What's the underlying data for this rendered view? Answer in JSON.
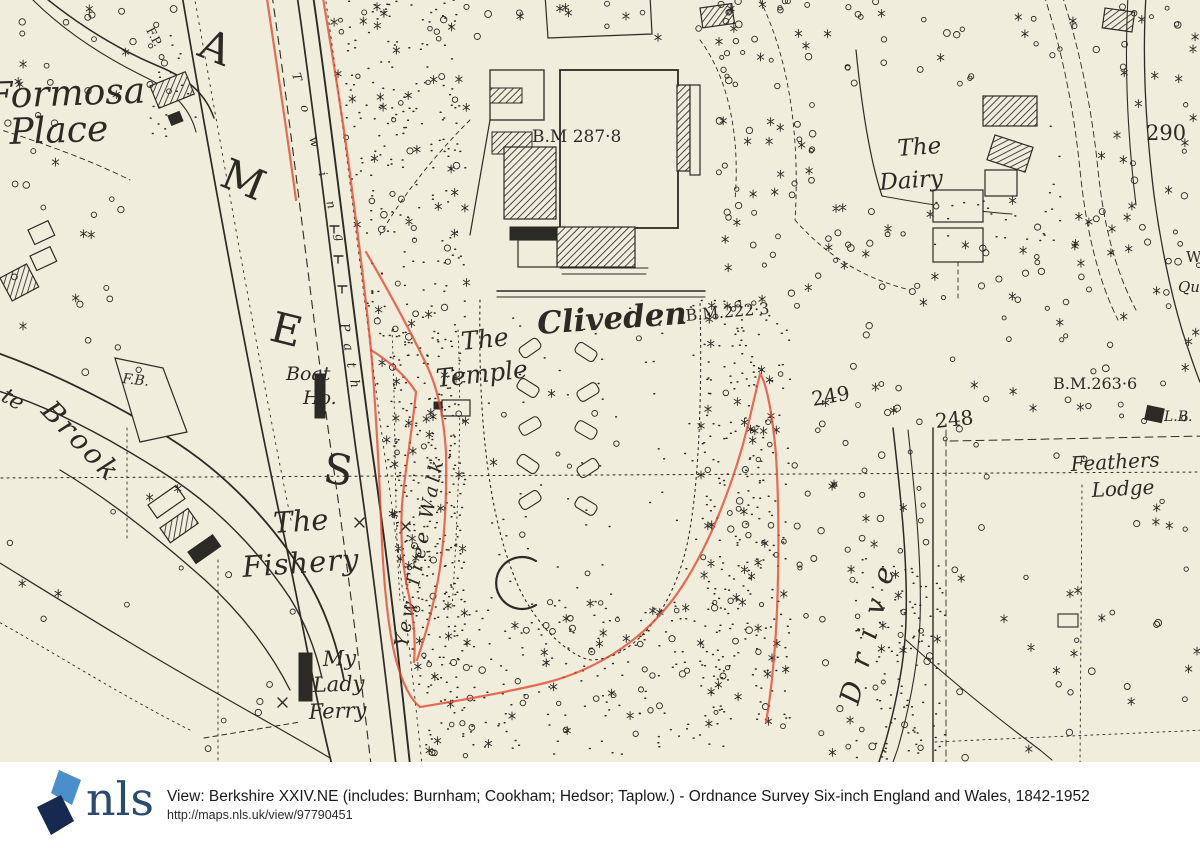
{
  "footer": {
    "logo_text": "nls",
    "title_line": "View: Berkshire XXIV.NE (includes: Burnham; Cookham; Hedsor; Taplow.) - Ordnance Survey Six-inch England and Wales, 1842-1952",
    "url_line": "http://maps.nls.uk/view/97790451",
    "colors": {
      "logo_navy": "#16294f",
      "logo_blue": "#4a8fc9",
      "logo_wordmark": "#2b4a70",
      "text": "#1a1a1a"
    }
  },
  "map": {
    "colors": {
      "paper": "#f1eddc",
      "ink": "#2b2a24",
      "red_overlay": "#e2452e"
    },
    "labels": [
      {
        "id": "formosa",
        "text": "Formosa",
        "x": -12,
        "y": 108,
        "size": 36,
        "rot": -2,
        "italic": true
      },
      {
        "id": "place",
        "text": "Place",
        "x": 10,
        "y": 144,
        "size": 36,
        "rot": -2,
        "italic": true
      },
      {
        "id": "thames-a",
        "text": "A",
        "x": 196,
        "y": 55,
        "size": 42,
        "rot": 22
      },
      {
        "id": "thames-m",
        "text": "M",
        "x": 218,
        "y": 185,
        "size": 42,
        "rot": 22
      },
      {
        "id": "thames-e",
        "text": "E",
        "x": 268,
        "y": 340,
        "size": 42,
        "rot": 14
      },
      {
        "id": "thames-s",
        "text": "S",
        "x": 322,
        "y": 482,
        "size": 42,
        "rot": 8
      },
      {
        "id": "towing",
        "text": "Towing",
        "x": 292,
        "y": 74,
        "size": 12,
        "rot": 75,
        "ls": 26,
        "italic": true
      },
      {
        "id": "path",
        "text": "Path",
        "x": 340,
        "y": 324,
        "size": 13,
        "rot": 80,
        "ls": 12,
        "italic": true
      },
      {
        "id": "fp",
        "text": "F.P.",
        "x": 146,
        "y": 30,
        "size": 12,
        "rot": 62
      },
      {
        "id": "fb",
        "text": "F.B.",
        "x": 122,
        "y": 383,
        "size": 14,
        "rot": 6,
        "italic": true
      },
      {
        "id": "tebrook-te",
        "text": "te",
        "x": 0,
        "y": 400,
        "size": 22,
        "rot": 30,
        "italic": true
      },
      {
        "id": "tebrook",
        "text": "Brook",
        "x": 40,
        "y": 412,
        "size": 28,
        "rot": 46,
        "ls": 3,
        "italic": true
      },
      {
        "id": "boat",
        "text": "Boat",
        "x": 286,
        "y": 380,
        "size": 19,
        "rot": 0,
        "italic": true
      },
      {
        "id": "boat-ho",
        "text": "Ho.",
        "x": 303,
        "y": 404,
        "size": 19,
        "rot": 0,
        "italic": true
      },
      {
        "id": "fishery-the",
        "text": "The",
        "x": 274,
        "y": 533,
        "size": 29,
        "rot": -4,
        "italic": true
      },
      {
        "id": "fishery",
        "text": "Fishery",
        "x": 243,
        "y": 577,
        "size": 29,
        "rot": -4,
        "ls": 1,
        "italic": true
      },
      {
        "id": "mylady-my",
        "text": "My",
        "x": 323,
        "y": 666,
        "size": 21,
        "rot": -2,
        "italic": true
      },
      {
        "id": "mylady-lady",
        "text": "Lady",
        "x": 313,
        "y": 692,
        "size": 21,
        "rot": -2,
        "italic": true
      },
      {
        "id": "mylady-ferry",
        "text": "Ferry",
        "x": 309,
        "y": 719,
        "size": 21,
        "rot": -2,
        "italic": true
      },
      {
        "id": "yew-tree-walk",
        "text": "Yew Tree Walk",
        "x": 407,
        "y": 648,
        "size": 19,
        "rot": -79,
        "ls": 4,
        "italic": true
      },
      {
        "id": "temple-the",
        "text": "The",
        "x": 462,
        "y": 350,
        "size": 25,
        "rot": -6,
        "italic": true
      },
      {
        "id": "temple",
        "text": "Temple",
        "x": 437,
        "y": 387,
        "size": 25,
        "rot": -6,
        "italic": true
      },
      {
        "id": "cliveden",
        "text": "Cliveden",
        "x": 538,
        "y": 334,
        "size": 31,
        "rot": -4,
        "italic": true,
        "weight": 600
      },
      {
        "id": "bm287",
        "text": "B.M 287·8",
        "x": 532,
        "y": 142,
        "size": 17
      },
      {
        "id": "bm222",
        "text": "B.M.222·3",
        "x": 686,
        "y": 321,
        "size": 16,
        "rot": -5
      },
      {
        "id": "bm263",
        "text": "B.M.263·6",
        "x": 1053,
        "y": 389,
        "size": 16
      },
      {
        "id": "spot-290",
        "text": "290",
        "x": 1146,
        "y": 140,
        "size": 21
      },
      {
        "id": "spot-249",
        "text": "249",
        "x": 813,
        "y": 406,
        "size": 20,
        "rot": -10
      },
      {
        "id": "spot-248",
        "text": "248",
        "x": 936,
        "y": 428,
        "size": 20,
        "rot": -6
      },
      {
        "id": "dairy-the",
        "text": "The",
        "x": 898,
        "y": 156,
        "size": 23,
        "rot": -4,
        "italic": true
      },
      {
        "id": "dairy",
        "text": "Dairy",
        "x": 880,
        "y": 190,
        "size": 23,
        "rot": -4,
        "italic": true
      },
      {
        "id": "feathers",
        "text": "Feathers",
        "x": 1071,
        "y": 471,
        "size": 20,
        "rot": -3,
        "italic": true
      },
      {
        "id": "lodge",
        "text": "Lodge",
        "x": 1092,
        "y": 497,
        "size": 20,
        "rot": -3,
        "italic": true
      },
      {
        "id": "drive",
        "text": "Drive",
        "x": 858,
        "y": 706,
        "size": 28,
        "rot": -75,
        "ls": 16,
        "italic": true
      },
      {
        "id": "lb",
        "text": "L.B.",
        "x": 1164,
        "y": 421,
        "size": 14,
        "italic": true
      },
      {
        "id": "w-edge",
        "text": "W",
        "x": 1186,
        "y": 262,
        "size": 15
      },
      {
        "id": "qu-edge",
        "text": "Qu",
        "x": 1178,
        "y": 292,
        "size": 15,
        "italic": true
      }
    ]
  }
}
